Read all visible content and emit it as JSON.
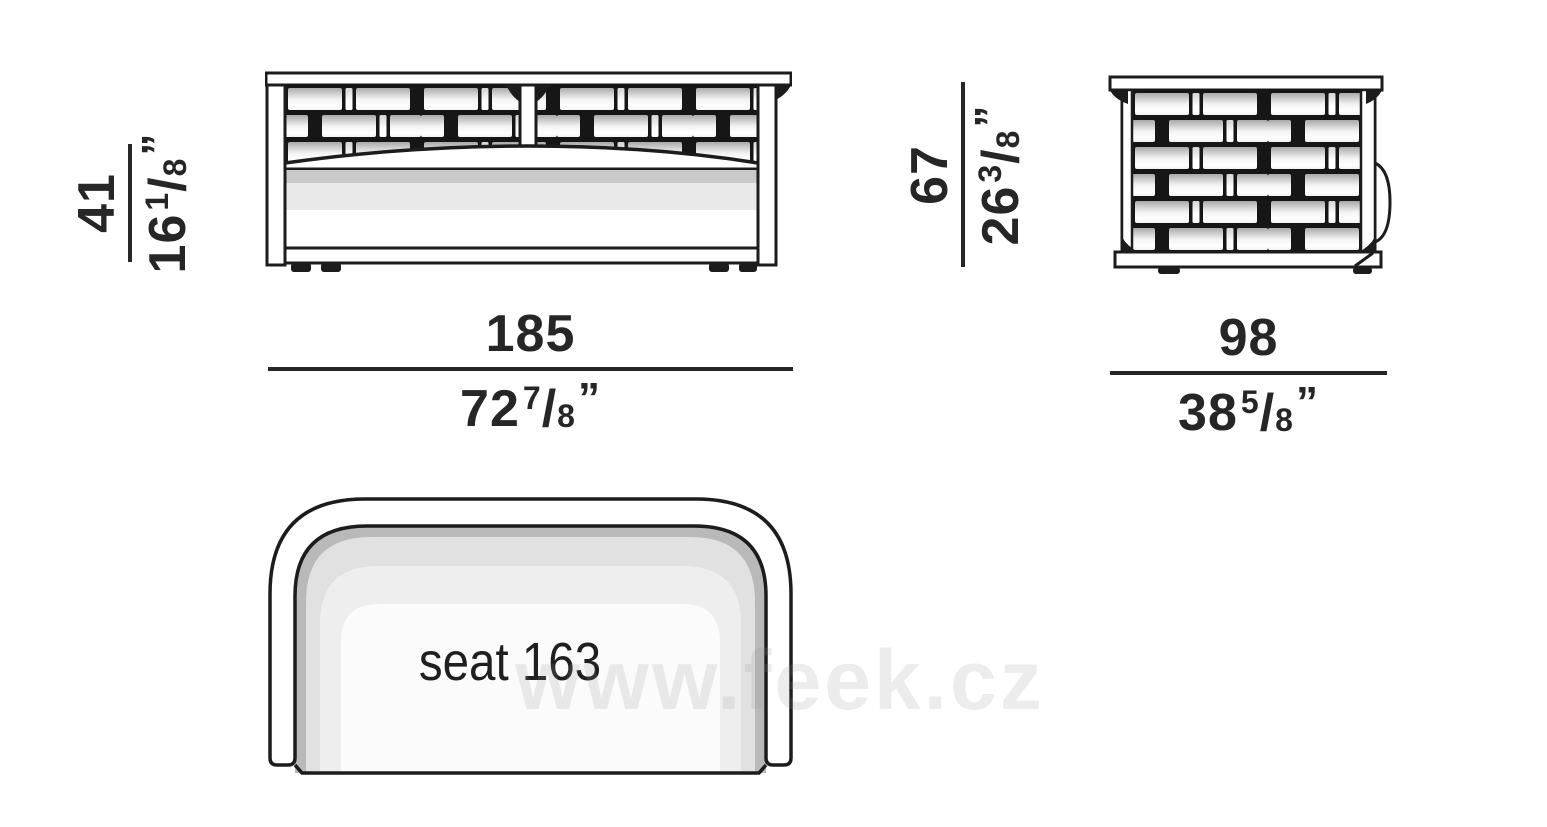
{
  "watermark": "www.feek.cz",
  "symbols": {
    "fraction_slash": "/"
  },
  "labels": {
    "seat": "seat 163"
  },
  "dims": {
    "front_height": {
      "cm": "41",
      "inch_whole": "16",
      "inch_num": "1",
      "inch_den": "8",
      "inch_mark": "”"
    },
    "front_width": {
      "cm": "185",
      "inch_whole": "72",
      "inch_num": "7",
      "inch_den": "8",
      "inch_mark": "”"
    },
    "side_height": {
      "cm": "67",
      "inch_whole": "26",
      "inch_num": "3",
      "inch_den": "8",
      "inch_mark": "”"
    },
    "side_depth": {
      "cm": "98",
      "inch_whole": "38",
      "inch_num": "5",
      "inch_den": "8",
      "inch_mark": "”"
    }
  },
  "colors": {
    "line": "#1c1c1c",
    "brick_top": "#a9a9a9",
    "cushion_dark": "#c9c9c9",
    "cushion_light": "#e9e9e9",
    "top_dark_band": "#b9b9b9",
    "top_light_band": "#e1e1e1",
    "seat_fill": "#eeeeee",
    "seat_center": "#fbfbfb",
    "watermark": "#e9e9e9"
  }
}
